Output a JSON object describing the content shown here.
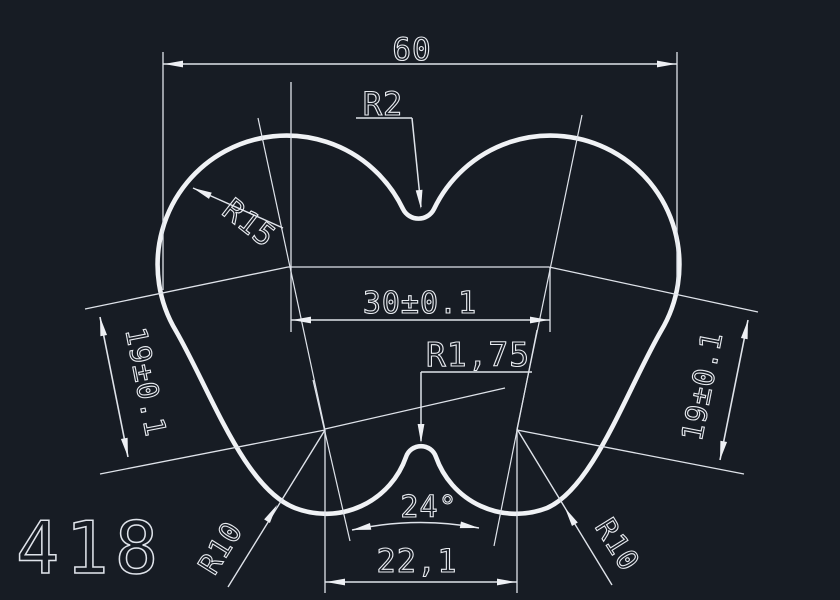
{
  "window": {
    "app": "CAD viewport",
    "background": "#171c24",
    "line_color": "#e8ebf0"
  },
  "drawing": {
    "dim_overall_width": "60",
    "radius_top_fillet": "R2",
    "radius_lobe": "R15",
    "dim_top_centers": "30±0.1",
    "radius_bottom_fillet": "R1,75",
    "dim_side_left": "19±0.1",
    "dim_side_right": "19±0.1",
    "dim_angle": "24°",
    "dim_bottom_centers": "22,1",
    "radius_bottom_left": "R10",
    "radius_bottom_right": "R10",
    "sheet_number": "418"
  }
}
